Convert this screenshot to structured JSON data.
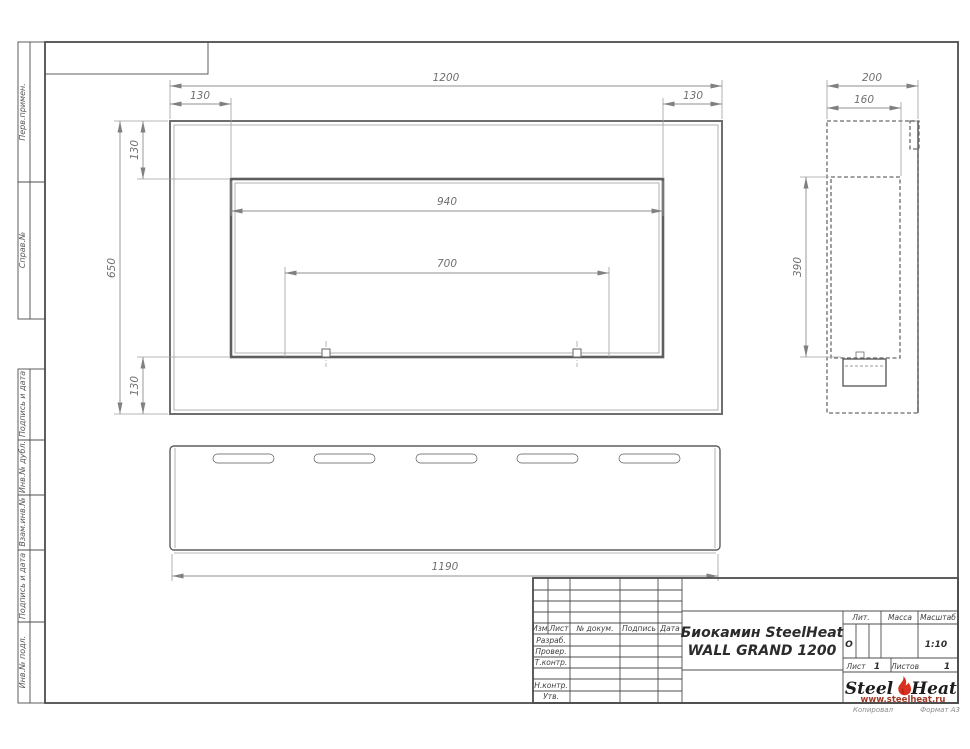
{
  "sheet": {
    "copy_note": "Копировал",
    "format_note": "Формат А3"
  },
  "margin_stamps": [
    {
      "label": "Перв.примен."
    },
    {
      "label": "Справ.№"
    },
    {
      "label": "Подпись и дата"
    },
    {
      "label": "Инв.№ дубл."
    },
    {
      "label": "Взам.инв.№"
    },
    {
      "label": "Подпись и дата"
    },
    {
      "label": "Инв.№ подл."
    }
  ],
  "views": {
    "front": {
      "overall_width": "1200",
      "offset_left": "130",
      "offset_right": "130",
      "opening_width": "940",
      "burner_span": "700",
      "overall_height": "650",
      "offset_top": "130",
      "offset_bottom": "130"
    },
    "side": {
      "depth": "200",
      "inner_depth": "160",
      "opening_height": "390"
    },
    "bottom": {
      "base_length": "1190"
    }
  },
  "title_block": {
    "header_cols": [
      "Изм.",
      "Лист",
      "№ докум.",
      "Подпись",
      "Дата"
    ],
    "sign_rows": [
      "Разраб.",
      "Провер.",
      "Т.контр.",
      "Н.контр.",
      "Утв."
    ],
    "title_line1": "Биокамин SteelHeat",
    "title_line2": "WALL GRAND 1200",
    "lit_label": "Лит.",
    "lit_value": "О",
    "mass_label": "Масса",
    "scale_label": "Масштаб",
    "scale_value": "1:10",
    "sheet_label": "Лист",
    "sheet_value": "1",
    "sheets_label": "Листов",
    "sheets_value": "1",
    "logo": {
      "word1": "Steel",
      "word2": "Heat",
      "url": "www.steelheat.ru",
      "flame_color": "#d93020",
      "flame_inner_color": "#a81f12",
      "url_color": "#a03a28"
    }
  }
}
